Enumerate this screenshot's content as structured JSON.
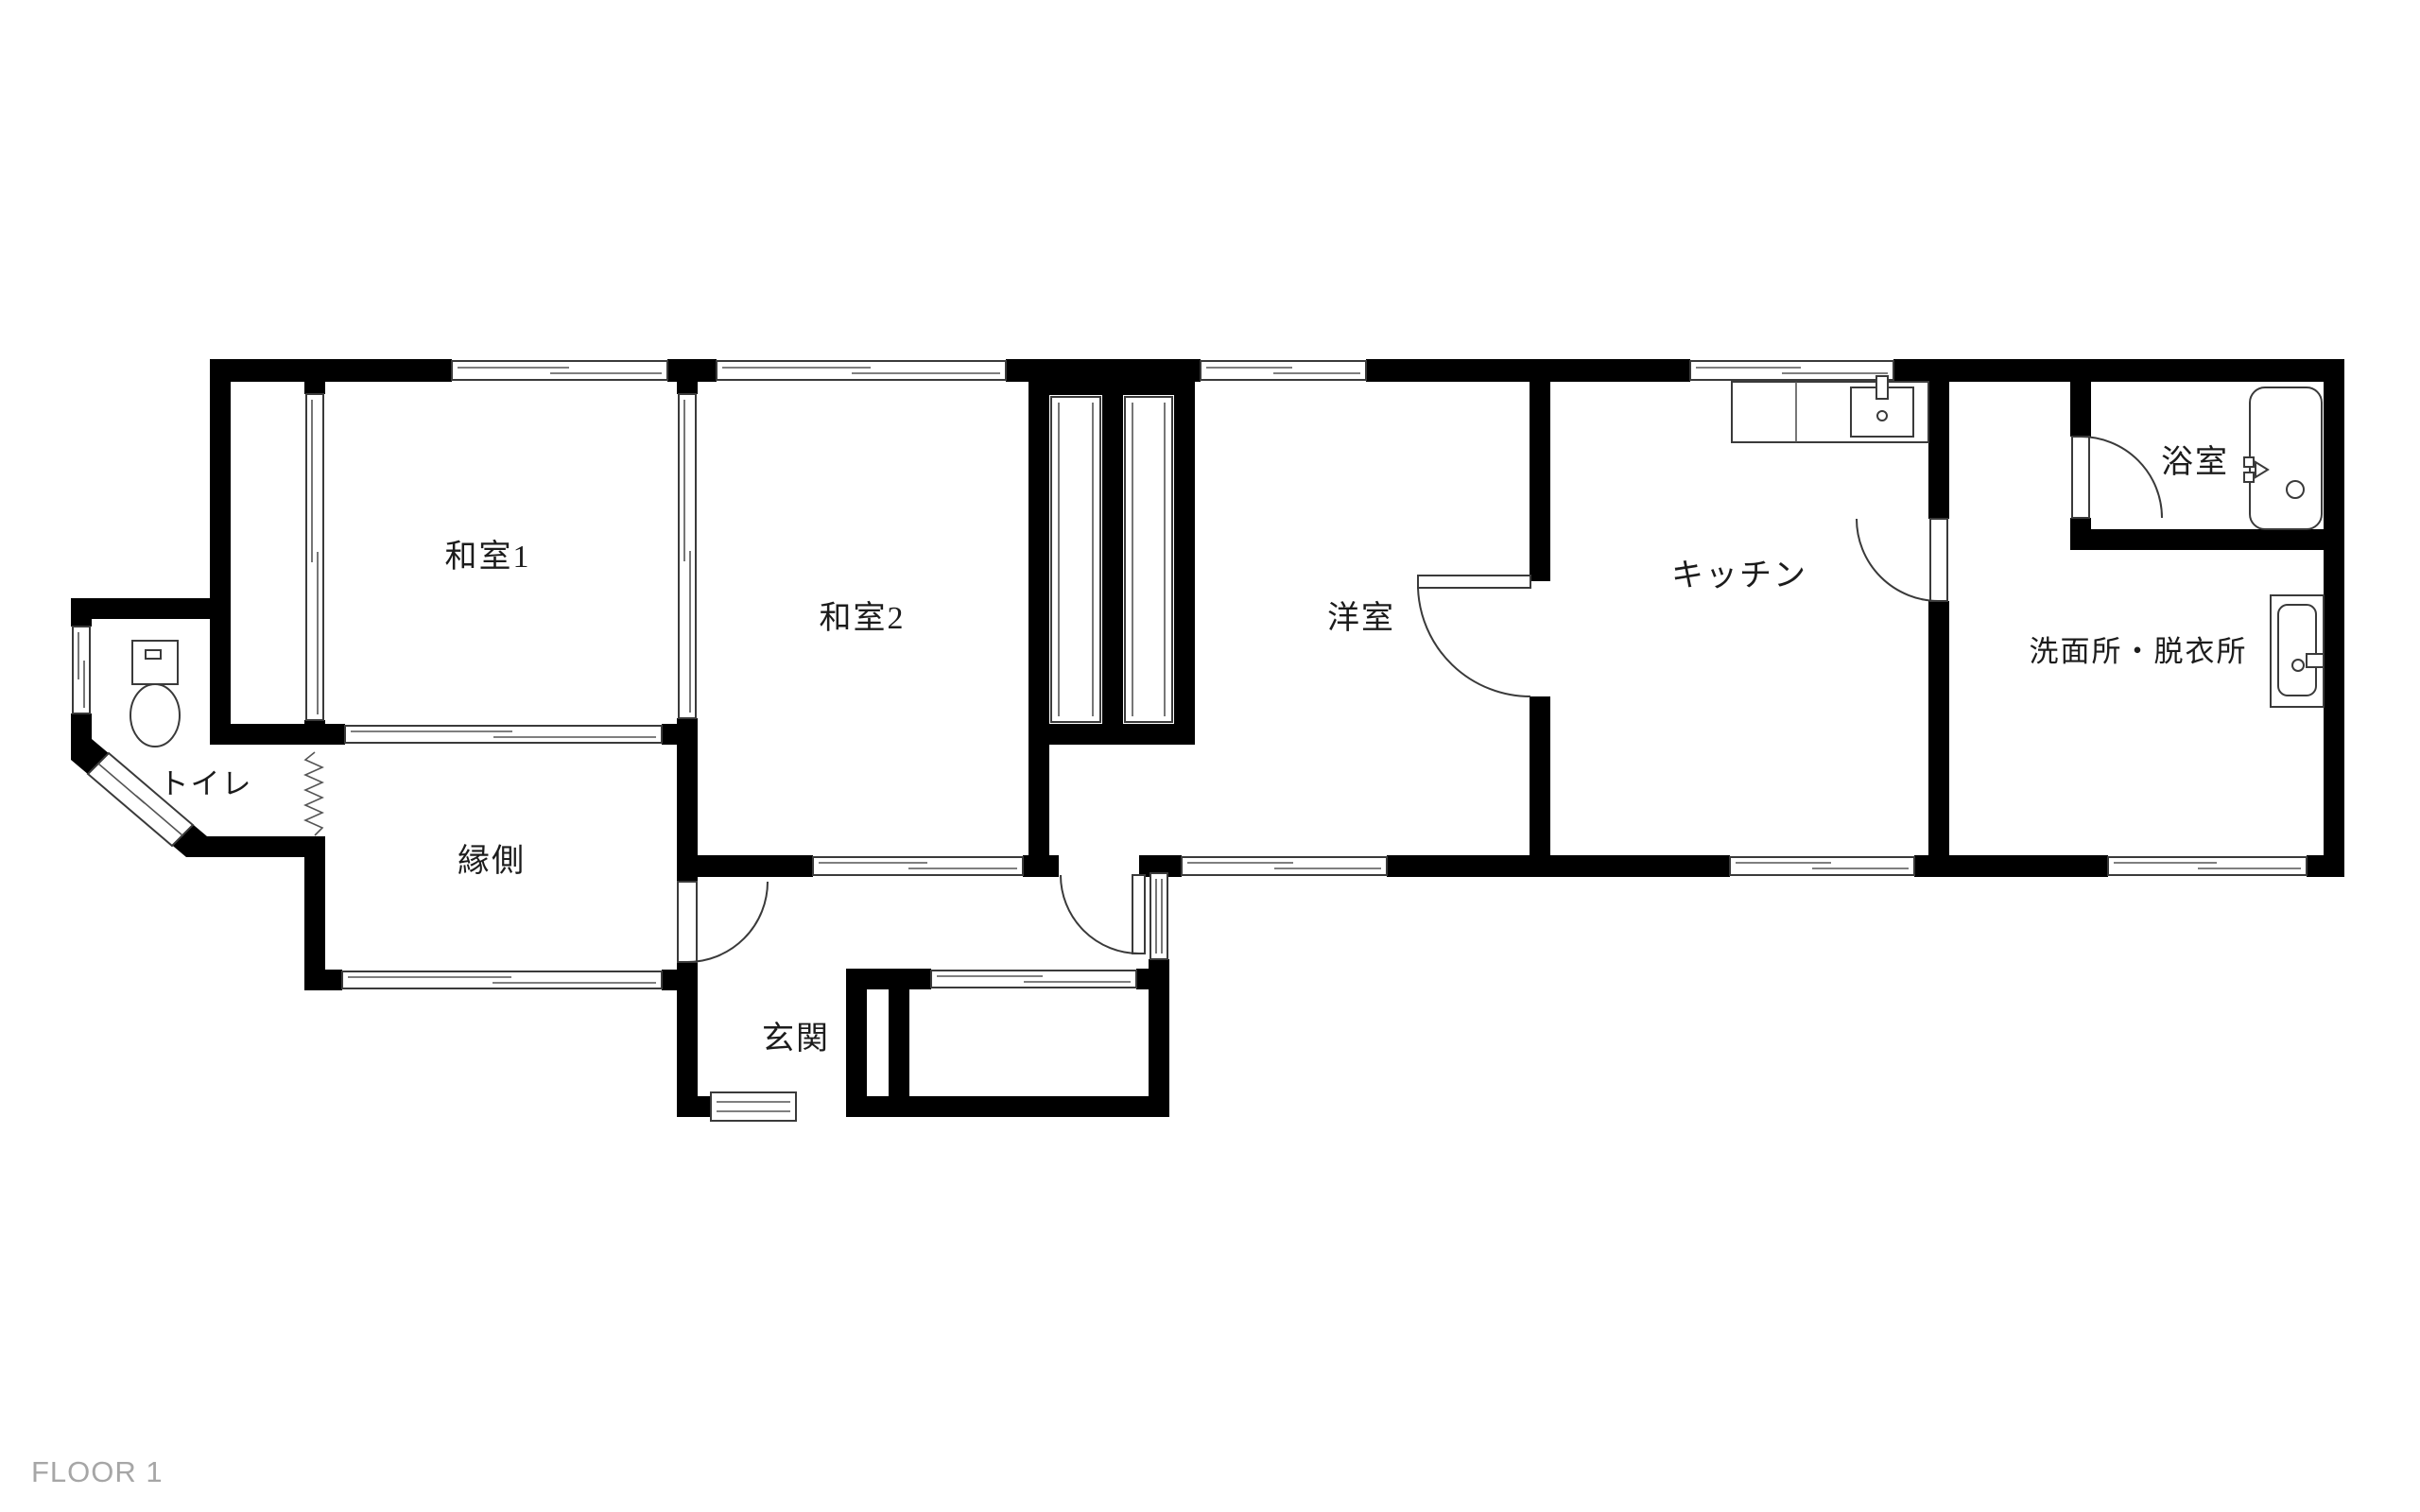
{
  "floor_plan": {
    "floor_label": "FLOOR 1",
    "rooms": {
      "washitsu1": {
        "label": "和室1"
      },
      "washitsu2": {
        "label": "和室2"
      },
      "yoshitsu": {
        "label": "洋室"
      },
      "kitchen": {
        "label": "キッチン"
      },
      "bathroom": {
        "label": "浴室"
      },
      "washroom": {
        "label": "洗面所・脱衣所"
      },
      "toilet": {
        "label": "トイレ"
      },
      "engawa": {
        "label": "縁側"
      },
      "genkan": {
        "label": "玄関"
      }
    },
    "fixtures": [
      "toilet",
      "kitchen-sink",
      "bathtub",
      "washbasin"
    ],
    "colors": {
      "wall": "#000000",
      "background": "#ffffff",
      "line": "#3a3a3a",
      "floor_label": "#a6a6a6"
    }
  }
}
